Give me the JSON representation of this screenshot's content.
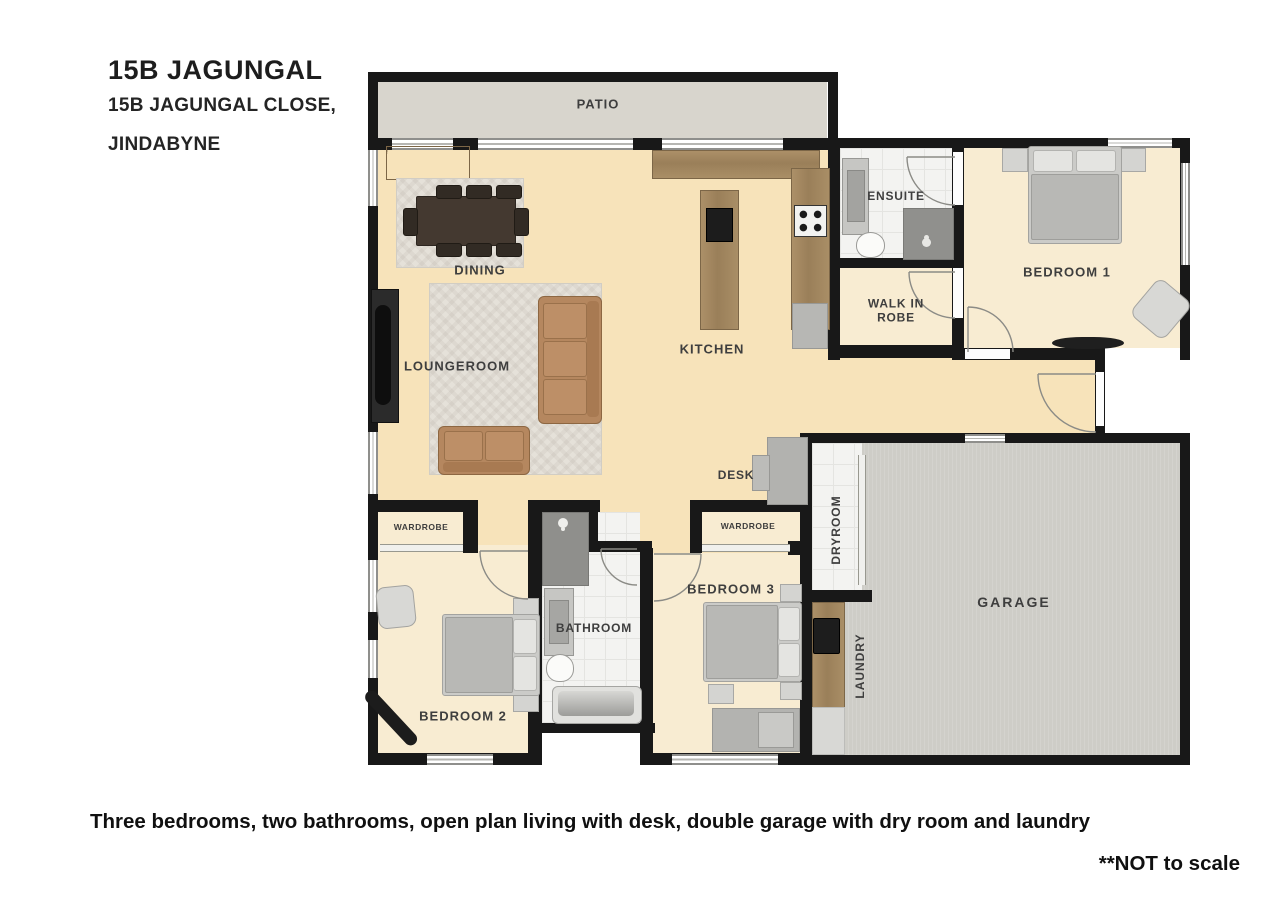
{
  "header": {
    "title": "15B JAGUNGAL",
    "address_line1": "15B JAGUNGAL CLOSE,",
    "address_line2": "JINDABYNE"
  },
  "plan": {
    "rooms": {
      "patio": "PATIO",
      "dining": "DINING",
      "loungeroom": "LOUNGEROOM",
      "kitchen": "KITCHEN",
      "desk": "DESK",
      "ensuite": "ENSUITE",
      "walk_in_robe": "WALK IN ROBE",
      "bedroom1": "BEDROOM 1",
      "dryroom": "DRYROOM",
      "garage": "GARAGE",
      "laundry": "LAUNDRY",
      "bathroom": "BATHROOM",
      "bedroom2": "BEDROOM 2",
      "bedroom3": "BEDROOM 3",
      "wardrobe_bedroom2": "WARDROBE",
      "wardrobe_bedroom3": "WARDROBE"
    }
  },
  "footer": {
    "description": "Three bedrooms, two bathrooms, open plan living with desk, double garage with dry room and laundry",
    "scale_note": "**NOT to scale"
  },
  "colors": {
    "wall": "#181818",
    "living_floor": "#f7e3ba",
    "bedroom_floor": "#f8ecd2",
    "patio_floor": "#d8d5cd",
    "garage_floor": "#cecdc7",
    "wet_room_floor": "#f3f3f1",
    "timber": "#a18a64",
    "sofa": "#b5875f",
    "rug": "#e5e1d9",
    "label_text": "#3e3e3e"
  }
}
